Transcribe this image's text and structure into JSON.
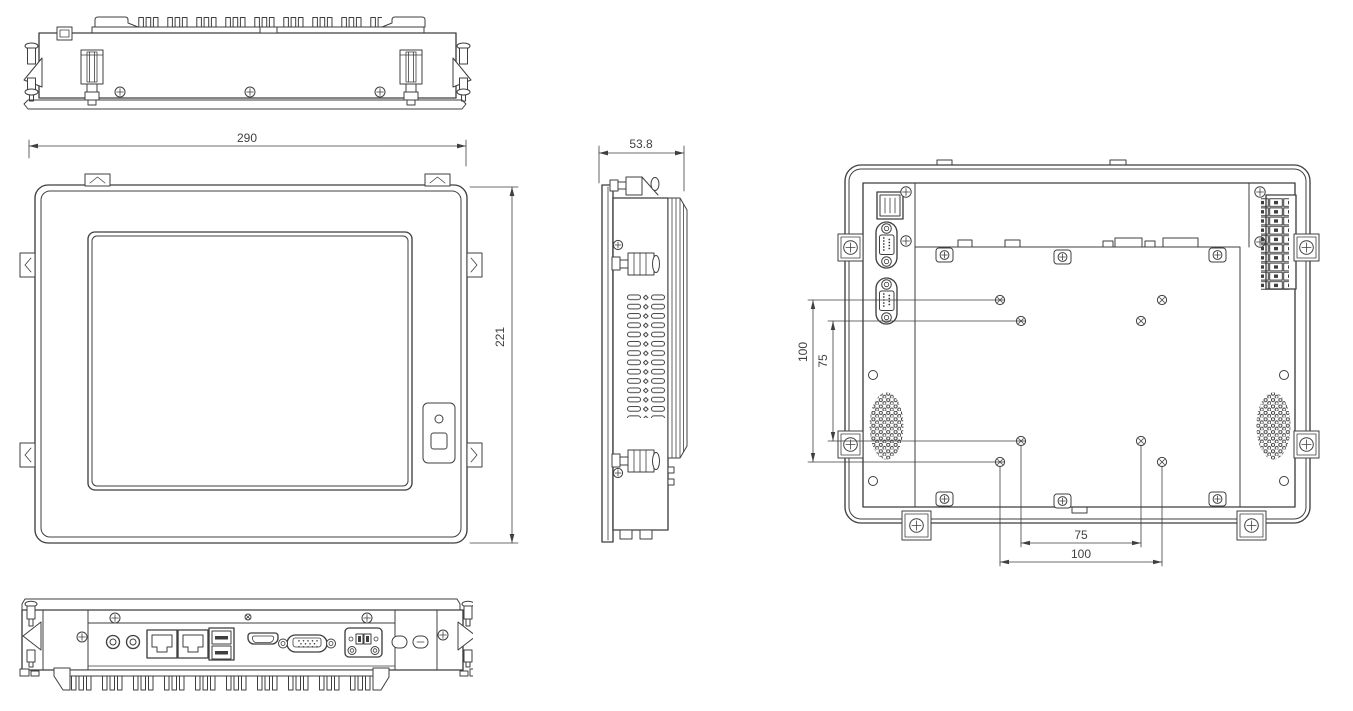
{
  "dimensions": {
    "front_width": "290",
    "front_height": "221",
    "side_depth": "53.8",
    "vesa_v_outer": "100",
    "vesa_v_inner": "75",
    "vesa_h_inner": "75",
    "vesa_h_outer": "100"
  },
  "colors": {
    "line": "#3f3f3f",
    "heatsink_fin_dark": "#5d5852",
    "background": "#ffffff"
  }
}
